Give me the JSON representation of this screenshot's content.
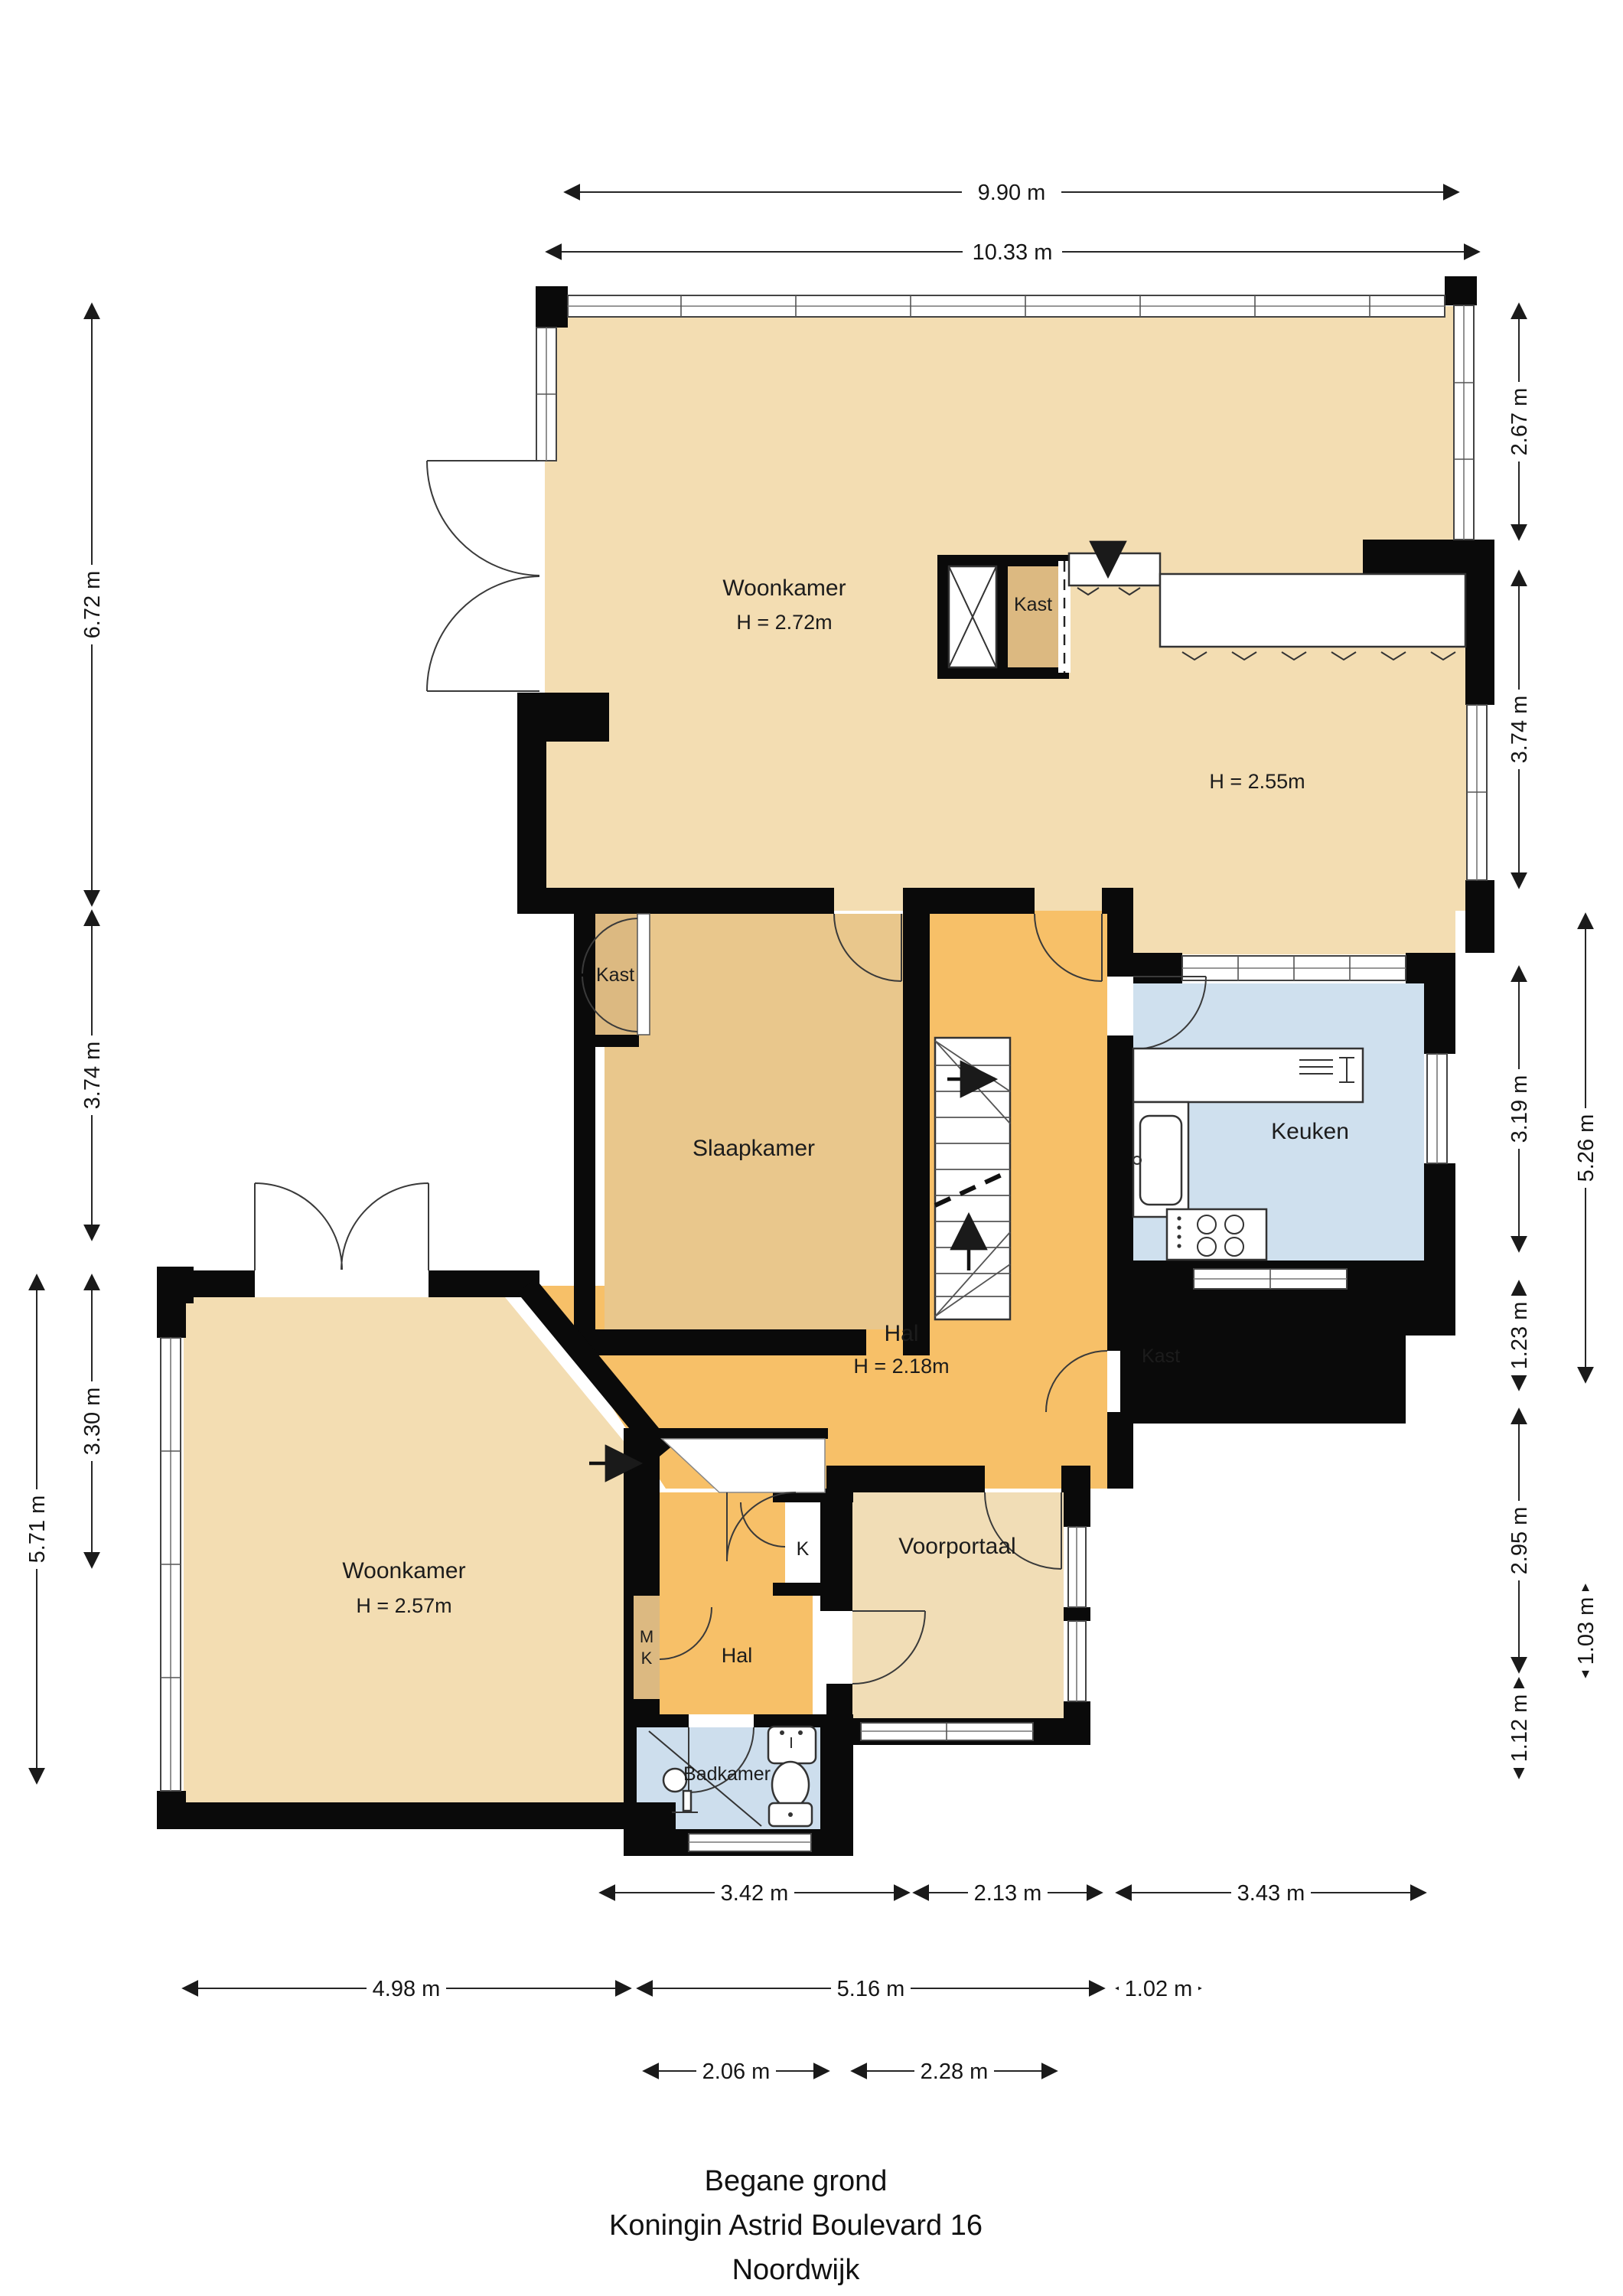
{
  "title": {
    "line1": "Begane grond",
    "line2": "Koningin Astrid Boulevard 16",
    "line3": "Noordwijk"
  },
  "rooms": {
    "woonkamer_top": {
      "label": "Woonkamer",
      "height": "H = 2.72m"
    },
    "kast_top": {
      "label": "Kast"
    },
    "dining": {
      "height": "H = 2.55m"
    },
    "slaapkamer": {
      "label": "Slaapkamer"
    },
    "kast_slaapkamer": {
      "label": "Kast"
    },
    "keuken": {
      "label": "Keuken"
    },
    "hal": {
      "label": "Hal",
      "height": "H = 2.18m"
    },
    "kast_hal": {
      "label": "Kast"
    },
    "woonkamer_beneden": {
      "label": "Woonkamer",
      "height": "H = 2.57m"
    },
    "voorportaal": {
      "label": "Voorportaal"
    },
    "k_closet": {
      "label": "K"
    },
    "meterkast": {
      "line1": "M",
      "line2": "K"
    },
    "hal_klein": {
      "label": "Hal"
    },
    "badkamer": {
      "label": "Badkamer"
    }
  },
  "dimensions": {
    "top": [
      "9.90 m",
      "10.33 m"
    ],
    "left": [
      "6.72 m",
      "3.74 m",
      "3.30 m",
      "5.71 m"
    ],
    "right": [
      "2.67 m",
      "3.74 m",
      "3.19 m",
      "1.23 m",
      "2.95 m",
      "1.12 m"
    ],
    "right_outer": [
      "5.26 m",
      "1.03 m"
    ],
    "bottom_row1": [
      "3.42 m",
      "2.13 m",
      "3.43 m"
    ],
    "bottom_row2": [
      "4.98 m",
      "5.16 m",
      "1.02 m"
    ],
    "bottom_row3": [
      "2.06 m",
      "2.28 m"
    ]
  },
  "colors": {
    "wall": "#0a0a0a",
    "room_tan": "#f3ddb2",
    "room_tan_light": "#f1ddb6",
    "room_orange": "#f7c068",
    "room_brown": "#e9c78c",
    "closet_tan": "#dcb981",
    "kitchen_blue": "#cfe0ee",
    "bath_blue": "#cddeed"
  }
}
